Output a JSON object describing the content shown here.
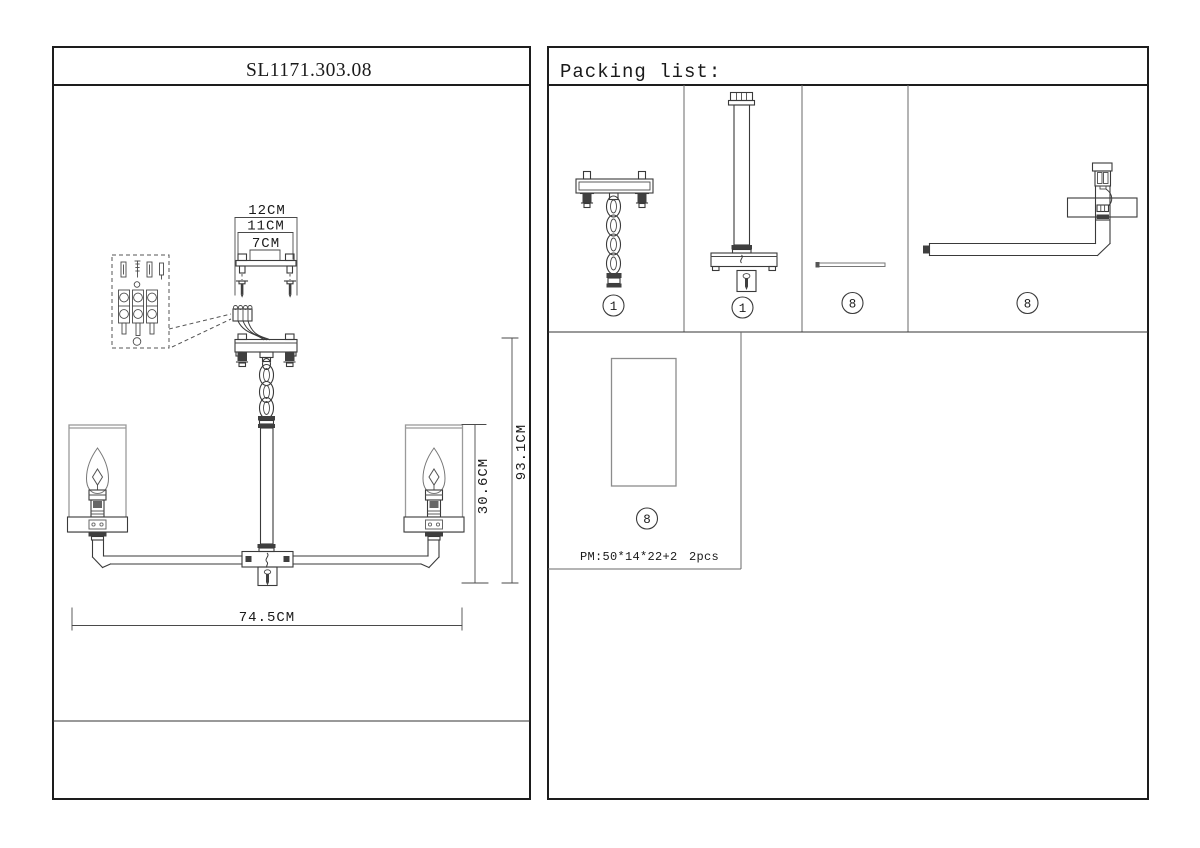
{
  "left_panel": {
    "model_number": "SL1171.303.08",
    "dimensions": {
      "mount_width_outer": "12CM",
      "mount_width_mid": "11CM",
      "mount_width_inner": "7CM",
      "overall_height": "93.1CM",
      "shade_section_height": "30.6CM",
      "overall_width": "74.5CM"
    }
  },
  "packing_list": {
    "title": "Packing list:",
    "items": [
      {
        "number": "1",
        "part": "ceiling-plate-with-chain"
      },
      {
        "number": "1",
        "part": "rod-with-canopy"
      },
      {
        "number": "8",
        "part": "connector-pin"
      },
      {
        "number": "8",
        "part": "arm-with-socket"
      },
      {
        "number": "8",
        "part": "glass-shade",
        "spec": "PM:50*14*22+2",
        "qty": "2pcs"
      }
    ]
  }
}
